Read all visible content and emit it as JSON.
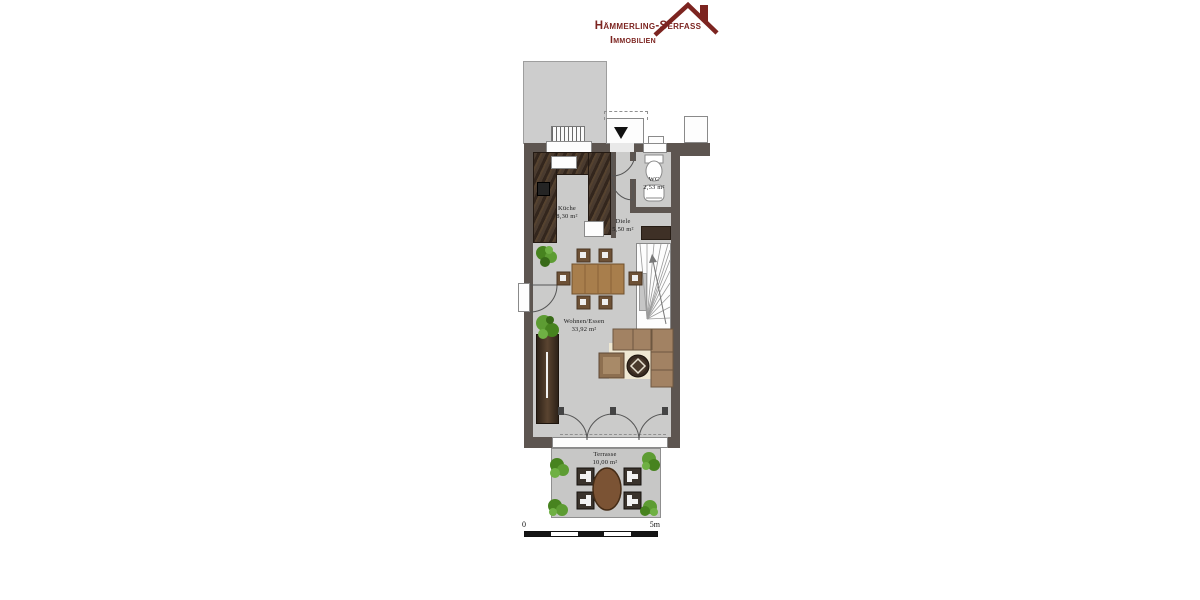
{
  "logo": {
    "line1": "Hämmerling-Serfass",
    "line2": "Immobilien",
    "brand_color": "#7c2420"
  },
  "floorplan": {
    "rooms": {
      "kueche": {
        "name": "Küche",
        "area": "8,30 m²"
      },
      "wc": {
        "name": "WC",
        "area": "2,53 m²"
      },
      "diele": {
        "name": "Diele",
        "area": "5,50 m²"
      },
      "wohnen_essen": {
        "name": "Wohnen/Essen",
        "area": "33,92 m²"
      },
      "terrasse": {
        "name": "Terrasse",
        "area": "10,00 m²"
      }
    },
    "colors": {
      "wall": "#5d5550",
      "floor": "#cbcbca",
      "neighbor_building": "#cdcdcd",
      "terrace": "#c7c7c6",
      "kitchen_counter": "#46382d",
      "wood_furniture": "#a87e4c",
      "sofa": "#a28263",
      "rug": "#efe8d3",
      "plant_green": "#5d9c33"
    }
  },
  "scale_bar": {
    "start_label": "0",
    "end_label": "5m"
  }
}
